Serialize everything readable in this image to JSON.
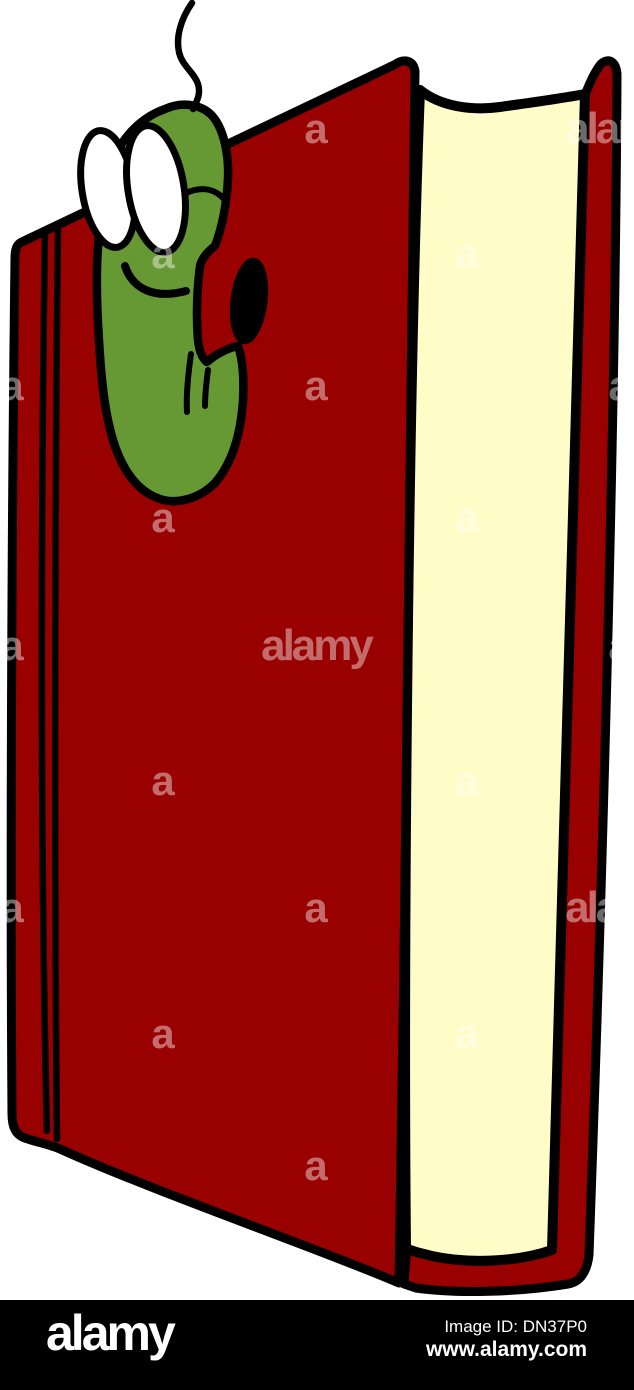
{
  "image": {
    "colors": {
      "background": "#FFFFFF",
      "cover_red": "#990000",
      "pages_cream": "#FFFCC8",
      "worm_green": "#669933",
      "outline_ink": "#000000",
      "lens_white": "#FFFFFF",
      "hole_black": "#000000"
    }
  },
  "watermarks": {
    "letter": "a",
    "word": "alamy",
    "color": "#FFFFFF",
    "opacity": 0.42,
    "items": [
      {
        "x": 12,
        "y": 143,
        "type": "letter"
      },
      {
        "x": 316,
        "y": 143,
        "type": "letter"
      },
      {
        "x": 620,
        "y": 143,
        "type": "word"
      },
      {
        "x": 163,
        "y": 268,
        "type": "letter"
      },
      {
        "x": 467,
        "y": 268,
        "type": "letter"
      },
      {
        "x": 12,
        "y": 400,
        "type": "letter"
      },
      {
        "x": 316,
        "y": 400,
        "type": "letter"
      },
      {
        "x": 620,
        "y": 400,
        "type": "letter"
      },
      {
        "x": 163,
        "y": 532,
        "type": "letter"
      },
      {
        "x": 467,
        "y": 532,
        "type": "letter"
      },
      {
        "x": 12,
        "y": 660,
        "type": "letter"
      },
      {
        "x": 316,
        "y": 660,
        "type": "word"
      },
      {
        "x": 620,
        "y": 660,
        "type": "letter"
      },
      {
        "x": 163,
        "y": 795,
        "type": "letter"
      },
      {
        "x": 467,
        "y": 795,
        "type": "letter"
      },
      {
        "x": 12,
        "y": 922,
        "type": "letter"
      },
      {
        "x": 316,
        "y": 922,
        "type": "letter"
      },
      {
        "x": 620,
        "y": 922,
        "type": "word"
      },
      {
        "x": 163,
        "y": 1048,
        "type": "letter"
      },
      {
        "x": 467,
        "y": 1048,
        "type": "letter"
      },
      {
        "x": 12,
        "y": 1180,
        "type": "letter"
      },
      {
        "x": 316,
        "y": 1180,
        "type": "letter"
      },
      {
        "x": 620,
        "y": 1180,
        "type": "letter"
      }
    ]
  },
  "footer_bar": {
    "background": "#000000",
    "text_color": "#FFFFFF",
    "logo": "alamy",
    "image_id_label": "Image ID: DN37P0",
    "website": "www.alamy.com"
  }
}
